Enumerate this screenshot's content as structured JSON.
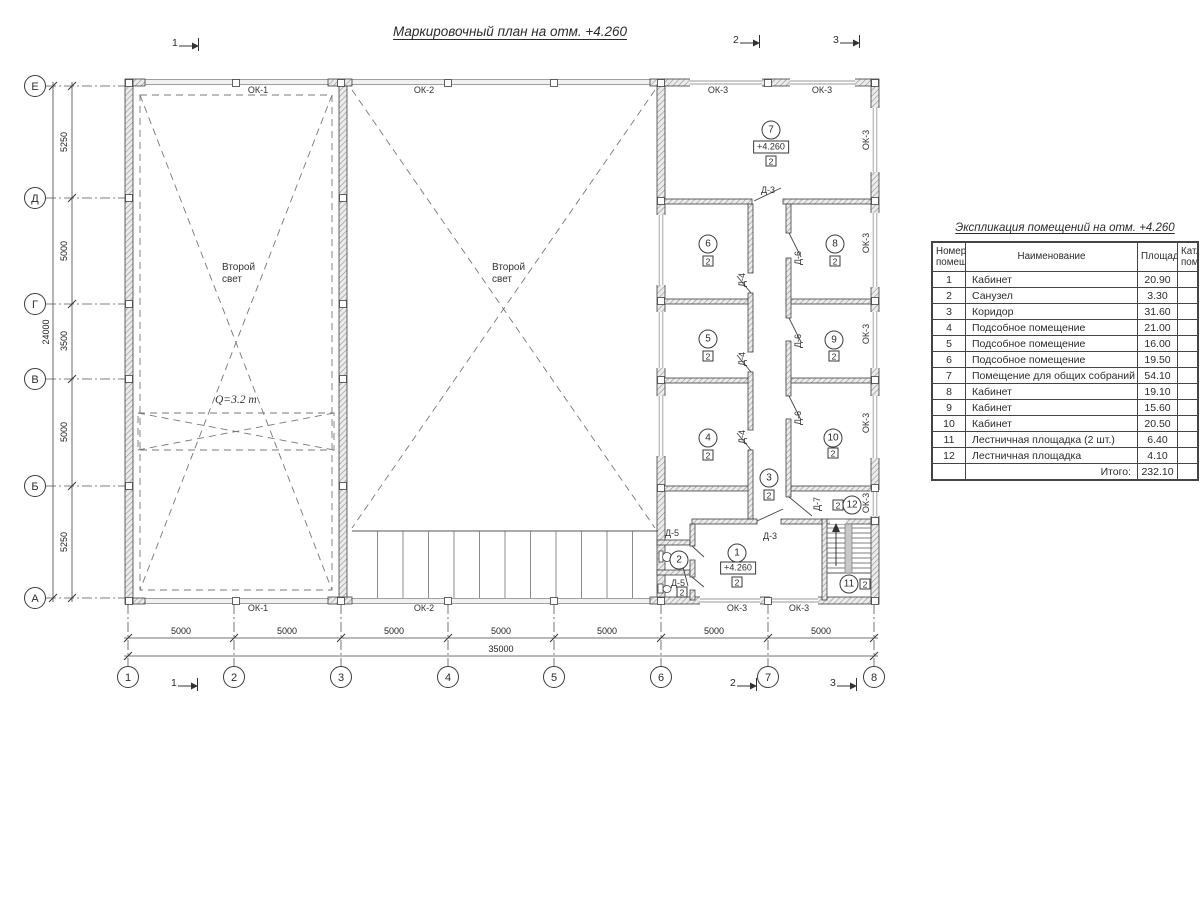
{
  "page": {
    "title": "Маркировочный план на отм. +4.260"
  },
  "schedule": {
    "title": "Экспликация помещений на отм. +4.260",
    "headers": {
      "num": "Номер\nпомещ.",
      "name": "Наименование",
      "area": "Площадь",
      "cat": "Кат.\nпом."
    },
    "rows": [
      {
        "num": "1",
        "name": "Кабинет",
        "area": "20.90",
        "cat": ""
      },
      {
        "num": "2",
        "name": "Санузел",
        "area": "3.30",
        "cat": ""
      },
      {
        "num": "3",
        "name": "Коридор",
        "area": "31.60",
        "cat": ""
      },
      {
        "num": "4",
        "name": "Подсобное помещение",
        "area": "21.00",
        "cat": ""
      },
      {
        "num": "5",
        "name": "Подсобное помещение",
        "area": "16.00",
        "cat": ""
      },
      {
        "num": "6",
        "name": "Подсобное помещение",
        "area": "19.50",
        "cat": ""
      },
      {
        "num": "7",
        "name": "Помещение для общих собраний",
        "area": "54.10",
        "cat": ""
      },
      {
        "num": "8",
        "name": "Кабинет",
        "area": "19.10",
        "cat": ""
      },
      {
        "num": "9",
        "name": "Кабинет",
        "area": "15.60",
        "cat": ""
      },
      {
        "num": "10",
        "name": "Кабинет",
        "area": "20.50",
        "cat": ""
      },
      {
        "num": "11",
        "name": "Лестничная площадка (2 шт.)",
        "area": "6.40",
        "cat": ""
      },
      {
        "num": "12",
        "name": "Лестничная площадка",
        "area": "4.10",
        "cat": ""
      }
    ],
    "total_label": "Итого:",
    "total_value": "232.10"
  },
  "plan": {
    "axis_rows": [
      {
        "label": "Е",
        "y": 86
      },
      {
        "label": "Д",
        "y": 198
      },
      {
        "label": "Г",
        "y": 304
      },
      {
        "label": "В",
        "y": 379
      },
      {
        "label": "Б",
        "y": 486
      },
      {
        "label": "А",
        "y": 598
      }
    ],
    "axis_cols": [
      {
        "label": "1",
        "x": 128
      },
      {
        "label": "2",
        "x": 234
      },
      {
        "label": "3",
        "x": 341
      },
      {
        "label": "4",
        "x": 448
      },
      {
        "label": "5",
        "x": 554
      },
      {
        "label": "6",
        "x": 661
      },
      {
        "label": "7",
        "x": 768
      },
      {
        "label": "8",
        "x": 874
      }
    ],
    "dims_left": [
      {
        "text": "5250",
        "y": 142
      },
      {
        "text": "5000",
        "y": 251
      },
      {
        "text": "3500",
        "y": 341
      },
      {
        "text": "5000",
        "y": 432
      },
      {
        "text": "5250",
        "y": 542
      }
    ],
    "dim_left_total": {
      "text": "24000",
      "x": 46,
      "y": 332
    },
    "dims_bottom": [
      {
        "text": "5000",
        "x": 181
      },
      {
        "text": "5000",
        "x": 287
      },
      {
        "text": "5000",
        "x": 394
      },
      {
        "text": "5000",
        "x": 501
      },
      {
        "text": "5000",
        "x": 607
      },
      {
        "text": "5000",
        "x": 714
      },
      {
        "text": "5000",
        "x": 821
      }
    ],
    "dim_bottom_total": {
      "text": "35000",
      "x": 501,
      "y": 649
    },
    "section_markers": [
      {
        "label": "1",
        "x": 172,
        "y": 32
      },
      {
        "label": "2",
        "x": 733,
        "y": 29
      },
      {
        "label": "3",
        "x": 833,
        "y": 29
      },
      {
        "label": "1",
        "x": 171,
        "y": 672
      },
      {
        "label": "2",
        "x": 730,
        "y": 672
      },
      {
        "label": "3",
        "x": 830,
        "y": 672
      }
    ],
    "window_labels": [
      {
        "text": "ОК-1",
        "x": 258,
        "y": 90,
        "rot": 0
      },
      {
        "text": "ОК-2",
        "x": 424,
        "y": 90,
        "rot": 0
      },
      {
        "text": "ОК-3",
        "x": 718,
        "y": 90,
        "rot": 0
      },
      {
        "text": "ОК-3",
        "x": 822,
        "y": 90,
        "rot": 0
      },
      {
        "text": "ОК-1",
        "x": 258,
        "y": 608,
        "rot": 0
      },
      {
        "text": "ОК-2",
        "x": 424,
        "y": 608,
        "rot": 0
      },
      {
        "text": "ОК-3",
        "x": 737,
        "y": 608,
        "rot": 0
      },
      {
        "text": "ОК-3",
        "x": 799,
        "y": 608,
        "rot": 0
      },
      {
        "text": "ОК-3",
        "x": 866,
        "y": 140,
        "rot": 1
      },
      {
        "text": "ОК-3",
        "x": 866,
        "y": 243,
        "rot": 1
      },
      {
        "text": "ОК-3",
        "x": 866,
        "y": 334,
        "rot": 1
      },
      {
        "text": "ОК-3",
        "x": 866,
        "y": 423,
        "rot": 1
      },
      {
        "text": "ОК-3",
        "x": 866,
        "y": 503,
        "rot": 1
      }
    ],
    "door_labels": [
      {
        "text": "Д-3",
        "x": 768,
        "y": 190,
        "rot": 0
      },
      {
        "text": "Д-3",
        "x": 770,
        "y": 536,
        "rot": 0
      },
      {
        "text": "Д-5",
        "x": 672,
        "y": 533,
        "rot": 0
      },
      {
        "text": "Д-5",
        "x": 678,
        "y": 583,
        "rot": 0
      },
      {
        "text": "Д-4",
        "x": 742,
        "y": 280,
        "rot": 1
      },
      {
        "text": "Д-4",
        "x": 742,
        "y": 359,
        "rot": 1
      },
      {
        "text": "Д-4",
        "x": 742,
        "y": 437,
        "rot": 1
      },
      {
        "text": "Д-6",
        "x": 798,
        "y": 258,
        "rot": 1
      },
      {
        "text": "Д-6",
        "x": 798,
        "y": 341,
        "rot": 1
      },
      {
        "text": "Д-6",
        "x": 798,
        "y": 418,
        "rot": 1
      },
      {
        "text": "Д-7",
        "x": 817,
        "y": 504,
        "rot": 1
      }
    ],
    "room_markers": [
      {
        "num": "1",
        "x": 737,
        "y": 553
      },
      {
        "num": "2",
        "x": 679,
        "y": 560
      },
      {
        "num": "3",
        "x": 769,
        "y": 478
      },
      {
        "num": "4",
        "x": 708,
        "y": 438
      },
      {
        "num": "5",
        "x": 708,
        "y": 339
      },
      {
        "num": "6",
        "x": 708,
        "y": 244
      },
      {
        "num": "7",
        "x": 771,
        "y": 130
      },
      {
        "num": "8",
        "x": 835,
        "y": 244
      },
      {
        "num": "9",
        "x": 834,
        "y": 340
      },
      {
        "num": "10",
        "x": 833,
        "y": 438
      },
      {
        "num": "11",
        "x": 849,
        "y": 584
      },
      {
        "num": "12",
        "x": 852,
        "y": 505
      }
    ],
    "cat_squares": [
      {
        "text": "2",
        "x": 737,
        "y": 582
      },
      {
        "text": "2",
        "x": 682,
        "y": 592
      },
      {
        "text": "2",
        "x": 769,
        "y": 495
      },
      {
        "text": "2",
        "x": 708,
        "y": 455
      },
      {
        "text": "2",
        "x": 708,
        "y": 356
      },
      {
        "text": "2",
        "x": 708,
        "y": 261
      },
      {
        "text": "2",
        "x": 771,
        "y": 161
      },
      {
        "text": "2",
        "x": 835,
        "y": 261
      },
      {
        "text": "2",
        "x": 834,
        "y": 356
      },
      {
        "text": "2",
        "x": 833,
        "y": 453
      },
      {
        "text": "2",
        "x": 865,
        "y": 584
      },
      {
        "text": "2",
        "x": 838,
        "y": 505
      }
    ],
    "elevation_marks": [
      {
        "text": "+4.260",
        "x": 771,
        "y": 147
      },
      {
        "text": "+4.260",
        "x": 738,
        "y": 568
      }
    ],
    "notes": [
      {
        "text": "Второй\nсвет",
        "x": 222,
        "y": 262
      },
      {
        "text": "Второй\nсвет",
        "x": 492,
        "y": 262
      }
    ],
    "crane_label": {
      "text": "Q=3.2 т",
      "x": 215,
      "y": 394
    },
    "colors": {
      "line": "#3f3f3f",
      "thin": "#555555",
      "dashed": "#777777",
      "glass": "#9a9a9a",
      "band": "#f1f1f1"
    }
  }
}
